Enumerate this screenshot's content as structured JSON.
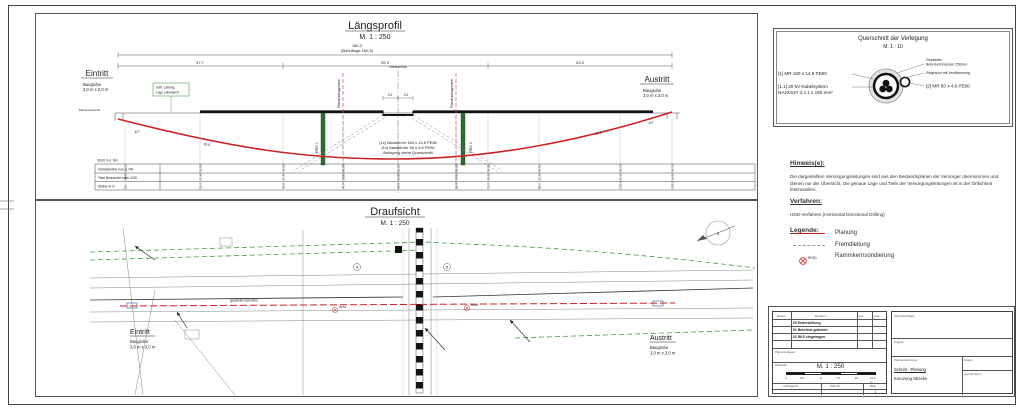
{
  "colors": {
    "planung_red": "#cc2222",
    "fremdleitung_gray": "#999999",
    "grenze_magenta": "#b84db8",
    "leitung_green": "#2e8b2e",
    "annotation_blue": "#4a6fa5"
  },
  "laengsprofil": {
    "title": "Längsprofil",
    "scale": "M. 1 : 250",
    "dim_total": "160,3",
    "dim_bohrlaenge": "(Bohrlänge 160,5)",
    "dim_left": "47,7",
    "dim_mid": "59,3",
    "dim_right": "53,3",
    "eintritt": "Eintritt",
    "austritt": "Austritt",
    "baugrube_line1": "Baugrube",
    "baugrube_line2": "3,0 m x 2,0 m",
    "entry_note": "Bohransatzpunkt",
    "entry_angle": "12°",
    "exit_angle": "10°",
    "entry_len": "15,4",
    "exit_len": "16,1",
    "gleis_label": "Gleisachse",
    "gleis_dim_l": "2,0",
    "gleis_dim_r": "2,0",
    "grenze_label_1": "Flurstücksgrenze",
    "grenze_label_2": "Flurstücksgrenze",
    "rks_label_1": "RKS 1",
    "rks_label_2": "RKS 2",
    "green_note_1": "vorh. Leitung",
    "green_note_2": "Lage unbekannt",
    "note_red_1": "(1x) Mantelrohr 160 x 14,6 PE80",
    "note_red_2": "(1x) Mantelrohr 50 x 4,6 PE80",
    "note_red_3": "Belegung siehe Querschnitt",
    "datum_nn": "30,00 m ü. NN",
    "band_row_1": "Geländehöhe in m ü. NN",
    "band_row_2": "Tiefe Bohrachse unter GOK",
    "band_row_3": "Station in m",
    "gelaende": [
      "36,20",
      "36,05",
      "35,98",
      "35,95",
      "35,92",
      "35,93",
      "35,95",
      "36,01",
      "36,10",
      "36,18"
    ],
    "achse": [
      "34,80",
      "32,40",
      "31,40",
      "30,95",
      "30,85",
      "30,88",
      "30,95",
      "31,30",
      "32,60",
      "34,90"
    ],
    "station": [
      "0,0",
      "15,4",
      "35,8",
      "47,7",
      "59,3",
      "68,4",
      "75,0",
      "95,1",
      "125,6",
      "160,3"
    ]
  },
  "draufsicht": {
    "title": "Draufsicht",
    "scale": "M. 1 : 250",
    "eintritt": "Eintritt",
    "austritt": "Austritt",
    "baugrube_line1": "Baugrube",
    "baugrube_line2": "3,0 m x 2,0 m",
    "bohrlinie_label": "geplante Bohrlinie",
    "north_label": "N",
    "marker_1": "4",
    "marker_2": "5",
    "rks1": "RKS1",
    "rks2": "RKS2"
  },
  "querschnitt": {
    "title": "Querschnitt der Verlegung",
    "scale": "M. 1 : 10",
    "label_mr160": "[1] MR 160 x 14,6 PE80",
    "label_kabel_1": "[1.1] 20-kV-Kabelsystem",
    "label_kabel_2": "NA2XS2Y 3 x 1 x 150 mm²",
    "callout_bohr_1": "Geplanter",
    "callout_bohr_2": "Bohrdurchmesser 250mm",
    "callout_ringraum": "Ringraum mit Verdämmung",
    "label_mr50": "[2] MR 50 x 4,6 PE80"
  },
  "hinweise": {
    "heading": "Hinweis(e):",
    "text": "Die dargestellten Versorgungsleitungen sind aus den Bestandsplänen der Versorger übernommen und dienen nur der Übersicht. Die genaue Lage und Tiefe der Versorgungsleitungen ist in der Örtlichkeit festzustellen."
  },
  "verfahren": {
    "heading": "Verfahren:",
    "text": "HDD-Verfahren (Horizontal Directional Drilling)"
  },
  "legende": {
    "heading": "Legende:",
    "item_planung": "Planung",
    "item_fremd": "Fremdleitung",
    "item_rks": "Rammkernsondierung",
    "rks_sym_label": "RKS1"
  },
  "titleblock": {
    "col_datum": "Datum",
    "col_revision": "Revision",
    "col_gez": "gez.",
    "col_gepr": "gepr.",
    "rev_0": "00 Ersterstellung",
    "rev_1": "01 Bohrlinie geändert",
    "rev_2": "02 RKS eingetragen",
    "planunterlagen": "Planunterlagen:",
    "massstab_label": "Maßstab",
    "massstab": "M. 1 : 250",
    "bar_0": "0",
    "bar_1": "2,5",
    "bar_2": "5",
    "bar_3": "7,5",
    "bar_4": "10",
    "bar_5": "12,5 m",
    "auftrag": "Auftrags-Nr.",
    "plannr": "Plan-Nr.",
    "blatt": "Blatt",
    "blatt_value": "1",
    "vorhaben": "Vorhabenträger",
    "projekt": "Projekt",
    "planbez_label": "Planbezeichnung",
    "planbez_1": "Schnitt - Planung",
    "planbez_2": "Kreuzung Strecke",
    "datum_label": "Datum",
    "gepr_label": "geprüft durch"
  }
}
